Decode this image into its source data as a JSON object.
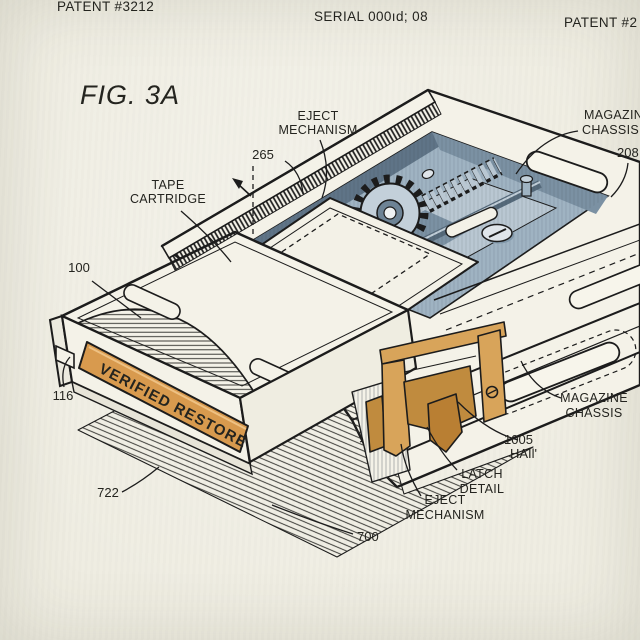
{
  "page": {
    "header": {
      "left": "PATENT #3212",
      "center": "SERIAL 000ıd; 08",
      "right": "PATENT #2"
    },
    "figure_title": "FIG. 3A"
  },
  "figure": {
    "cartridge_label": "VERIFIED RESTORE",
    "callouts": {
      "eject_top": [
        "EJECT",
        "MECHANISM"
      ],
      "ref265": "265",
      "magazine_top": [
        "MAGAZINE",
        "CHASSIS"
      ],
      "ref208": "208",
      "tape_cartridge": [
        "TAPE",
        "CARTRIDGE"
      ],
      "ref100": "100",
      "ref116": "116",
      "magazine_right": [
        "MAGAZINE",
        "CHASSIS"
      ],
      "ref1005": "1005",
      "ref1005_sub": "HAIl'",
      "latch_detail": [
        "LATCH",
        "DETAIL"
      ],
      "eject_bottom": [
        "EJECT",
        "MECHANISM"
      ],
      "ref722": "722",
      "ref700": "700"
    },
    "colors": {
      "paper": "#efede2",
      "ink": "#1c1c1c",
      "mechanism_blue": "#9fb3c2",
      "mechanism_blue_dark": "#6d8395",
      "mechanism_blue_light": "#c3d0da",
      "label_orange": "#d89a4e",
      "latch_orange": "#d8a45a"
    }
  }
}
